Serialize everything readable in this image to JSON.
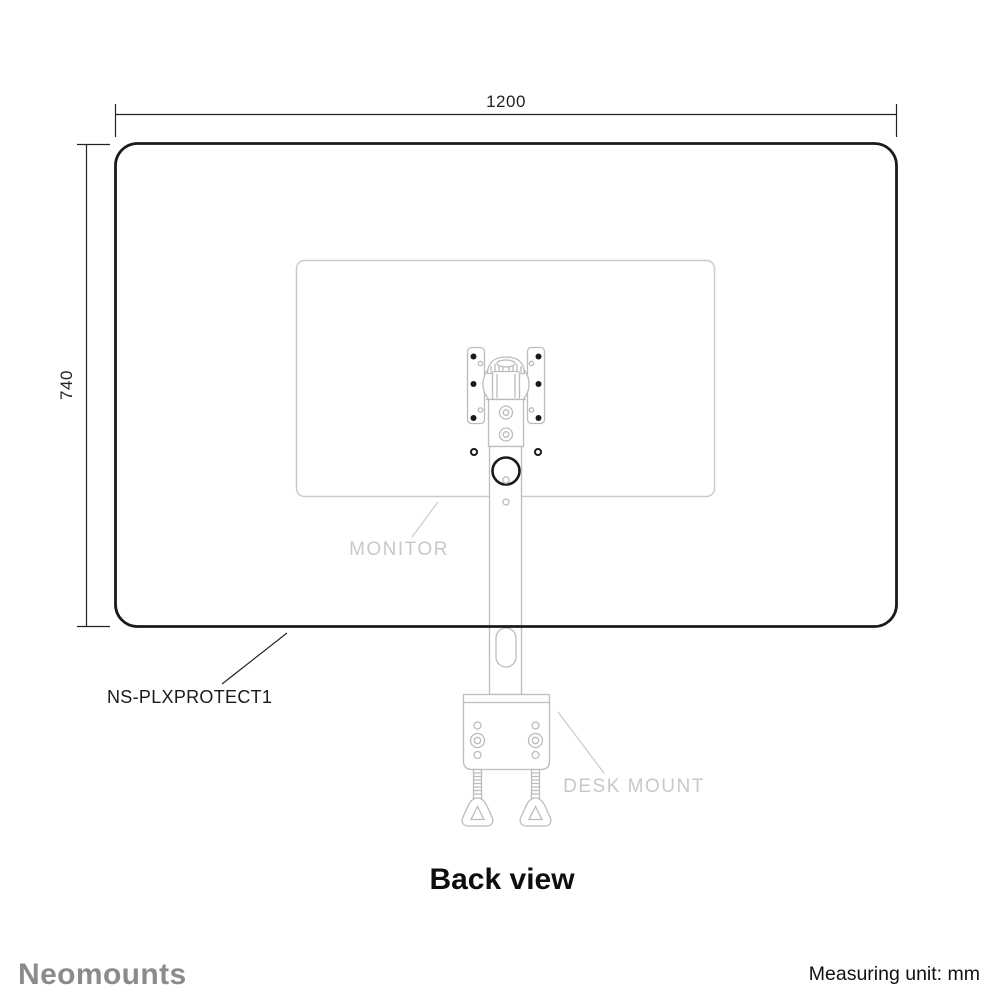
{
  "diagram": {
    "view_title": "Back view",
    "product_code": "NS-PLXPROTECT1",
    "dimensions": {
      "width_mm": "1200",
      "height_mm": "740"
    },
    "callouts": {
      "monitor": "MONITOR",
      "desk_mount": "DESK MOUNT"
    }
  },
  "footer": {
    "brand": "Neomounts",
    "measuring_unit": "Measuring unit: mm"
  },
  "colors": {
    "outline_black": "#1a1a1a",
    "dim_black": "#222222",
    "component_gray": "#b9bdbf",
    "monitor_gray": "#c9cbcc",
    "label_gray": "#c6c9cb",
    "brand_gray": "#8b8b8b"
  }
}
